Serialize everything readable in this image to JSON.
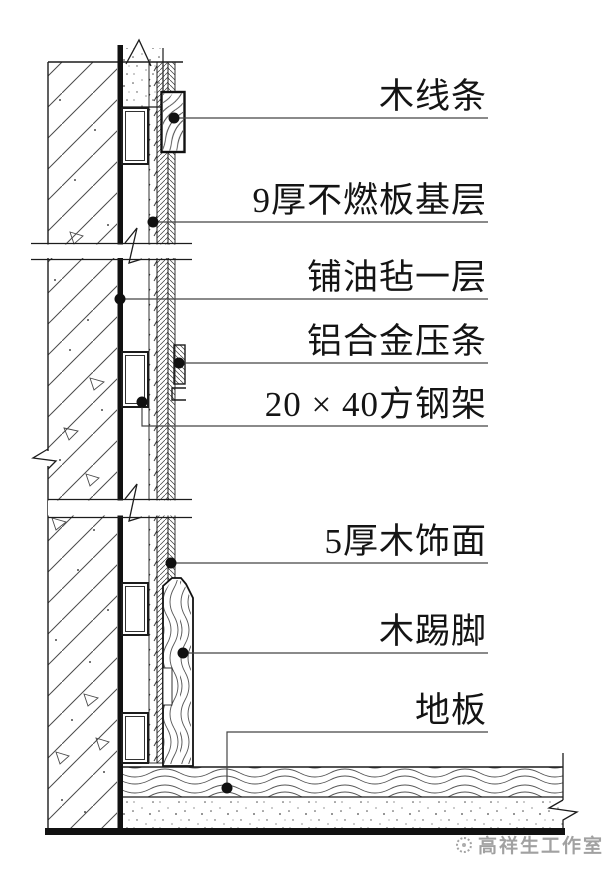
{
  "callouts": [
    {
      "id": "molding",
      "label": "木线条"
    },
    {
      "id": "fireproof-board",
      "label": "9厚不燃板基层"
    },
    {
      "id": "felt",
      "label": "铺油毡一层"
    },
    {
      "id": "aluminum-strip",
      "label": "铝合金压条"
    },
    {
      "id": "steel-frame",
      "label": "20 × 40方钢架"
    },
    {
      "id": "wood-veneer",
      "label": "5厚木饰面"
    },
    {
      "id": "skirting",
      "label": "木踢脚"
    },
    {
      "id": "floor",
      "label": "地板"
    }
  ],
  "watermark": {
    "studio": "高祥生工作室"
  },
  "colors": {
    "line": "#1c1c1c",
    "leader": "#454545",
    "watermark": "#979797"
  }
}
